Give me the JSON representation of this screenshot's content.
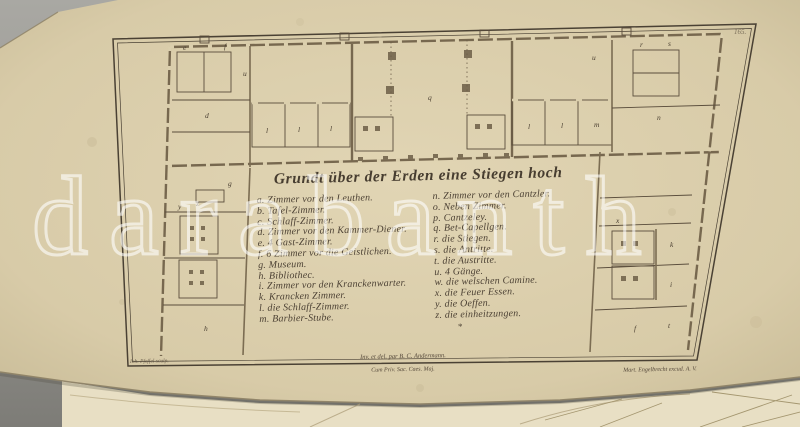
{
  "colors": {
    "backdrop_gray": "#a2a19c",
    "backdrop_dark": "#807f7a",
    "paper": "#dacdaa",
    "under_sheet": "#e8dfc4",
    "ink": "#56493a",
    "watermark": "#ffffff"
  },
  "watermark": {
    "text": "darabanth"
  },
  "plate": {
    "number": "165.",
    "title": "Grundt über der Erden eine Stiegen hoch",
    "legend": {
      "left": [
        "a. Zimmer vor den Leuthen.",
        "b. Tafel-Zimmer.",
        "c. Schlaff-Zimmer.",
        "d. Zimmer vor den Kammer-Diener.",
        "e. 4 Gast-Zimmer.",
        "f. 6 Zimmer vor die Geistlichen.",
        "g. Museum.",
        "h. Bibliothec.",
        "i. Zimmer vor den Kranckenwarter.",
        "k. Krancken Zimmer.",
        "l. die Schlaff-Zimmer.",
        "m. Barbier-Stube."
      ],
      "right": [
        "n. Zimmer vor den Cantzler.",
        "o. Neben Zimmer.",
        "p. Cantzeley.",
        "q. Bet-Capellgen.",
        "r. die Stiegen.",
        "s. die Antritte.",
        "t. die Austritte.",
        "u. 4 Gänge.",
        "w. die welschen Camine.",
        "x. die Feuer Essen.",
        "y. die Oeffen.",
        "z. die einheitzungen."
      ],
      "footnote_mark": "*"
    },
    "credits": {
      "left": "Ioh. Pfeffel sculp.",
      "center_top": "Inv. et del. par B. C. Andermann.",
      "center_bottom": "Cum Priv. Sac. Caes. Maj.",
      "right": "Mart. Engelbrecht excud. A. V."
    },
    "plan": {
      "labels": {
        "e": "e",
        "f": "f",
        "d": "d",
        "g": "g",
        "u1": "u",
        "u2": "u",
        "q": "q",
        "l1": "l",
        "l2": "l",
        "l3": "l",
        "l4": "l",
        "l5": "l",
        "m": "m",
        "r": "r",
        "s": "s",
        "n": "n",
        "x": "x",
        "y": "y",
        "z": "z",
        "k": "k",
        "i": "i",
        "h": "h",
        "f2": "f",
        "t": "t"
      }
    }
  }
}
